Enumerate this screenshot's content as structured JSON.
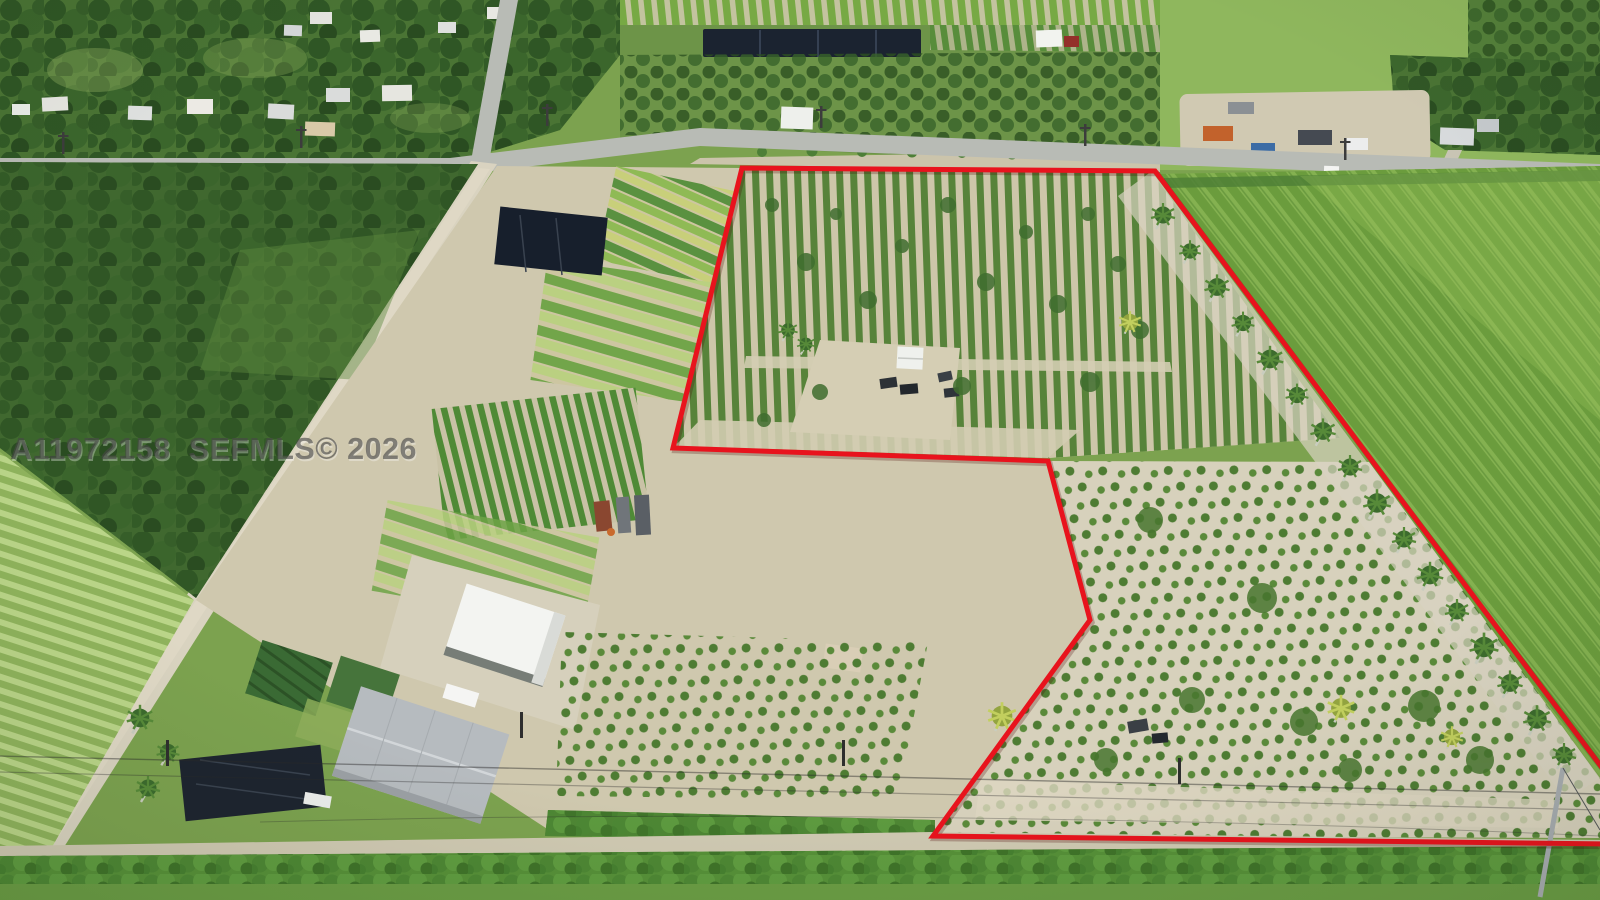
{
  "watermark": {
    "text": "A11972158  SEFMLS© 2026"
  },
  "boundary": {
    "points": "742,168 1155,171 1612,781 1612,844 933,836 1090,620 1048,461 673,448",
    "color": "#e8131d",
    "stroke_width": "5"
  },
  "palette": {
    "canopy_green": "#3f682e",
    "field_green": "#7fae4a",
    "row_green": "#57833a",
    "sand": "#cfc8ae",
    "road_gray": "#b8bbb5",
    "dirt_road": "#d9d3c0",
    "shade_structure_black": "#1b2330",
    "barn_roof_white": "#f3f4f1",
    "warehouse_roof_gray": "#b6bbbf",
    "hedge_green": "#4c8733",
    "watermark_gray": "#474747"
  }
}
